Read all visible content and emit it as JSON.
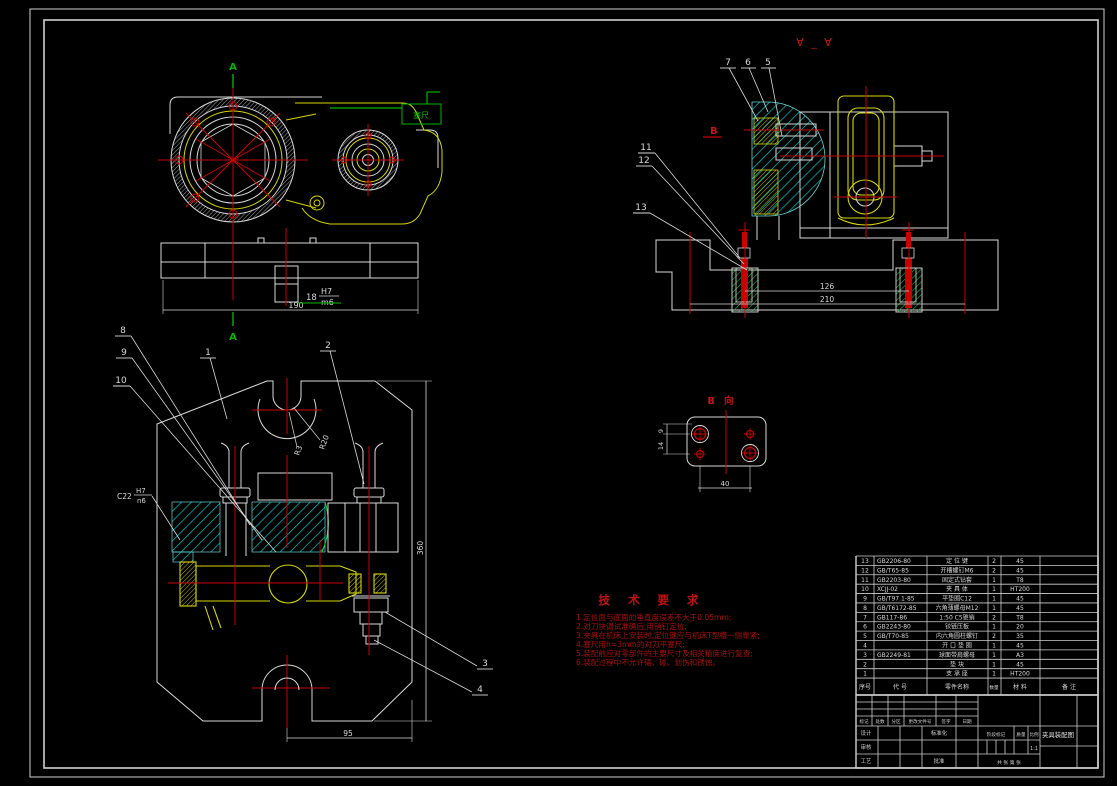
{
  "colors": {
    "background": "#000000",
    "white_line": "#d9d9d9",
    "red_line": "#c80000",
    "green_line": "#00b400",
    "yellow_line": "#d6d600",
    "cyan_hatch": "#00c8c8"
  },
  "labels": {
    "section_a_top": "A",
    "section_a_bottom": "A",
    "section_vv_title": "∀ _ ∀",
    "view_b_title": "B 向",
    "b_ref": "B",
    "feeler": "塞尺"
  },
  "balloons": {
    "1": "1",
    "2": "2",
    "3": "3",
    "4": "4",
    "5": "5",
    "6": "6",
    "7": "7",
    "8": "8",
    "9": "9",
    "10": "10",
    "11": "11",
    "12": "12",
    "13": "13"
  },
  "dims": {
    "d18": "18",
    "fit_u": "H7",
    "fit_l": "m6",
    "d190": "190",
    "d126": "126",
    "d210": "210",
    "d95": "95",
    "d360": "360",
    "d40": "40",
    "d9": "9",
    "d14": "14",
    "r3": "R3",
    "r20": "R20",
    "c22": "C22",
    "c22_u": "H7",
    "c22_l": "n6"
  },
  "tech_req": {
    "title": "技 术 要 求",
    "items": [
      "1.定位面与底面的垂直度误差不大于0.05mm;",
      "2.对刀块调试准确后,用销钉定位;",
      "3.夹具在机床上安装时,定位键应与机床T型槽一侧靠紧;",
      "4.塞尺用h=3mm的对刀平塞尺;",
      "5.装配前应对零部件的主要尺寸及相关精度进行复查;",
      "6.装配过程中不允许磕、碰、划伤和锈蚀。"
    ]
  },
  "bom": {
    "headers": [
      "序号",
      "代  号",
      "零件名称",
      "数量",
      "材 料",
      "备  注"
    ],
    "rows": [
      [
        "13",
        "GB2206-80",
        "定 位 键",
        "2",
        "45",
        ""
      ],
      [
        "12",
        "GB/T65-85",
        "开槽螺钉M6",
        "2",
        "45",
        ""
      ],
      [
        "11",
        "GB2203-80",
        "固定式钻套",
        "1",
        "T8",
        ""
      ],
      [
        "10",
        "XCJJ-02",
        "夹 具 体",
        "1",
        "HT200",
        ""
      ],
      [
        "9",
        "GB/T97.1-85",
        "平垫圈C12",
        "1",
        "45",
        ""
      ],
      [
        "8",
        "GB/T6172-85",
        "六角薄螺母M12",
        "1",
        "45",
        ""
      ],
      [
        "7",
        "GB117-86",
        "1:50 C5锥销",
        "2",
        "T8",
        ""
      ],
      [
        "6",
        "GB2243-80",
        "铰链压板",
        "1",
        "20",
        ""
      ],
      [
        "5",
        "GB/T70-85",
        "内六角圆柱螺钉",
        "2",
        "35",
        ""
      ],
      [
        "4",
        "",
        "开 口 垫 圈",
        "1",
        "45",
        ""
      ],
      [
        "3",
        "GB2249-81",
        "球面带肩螺母",
        "1",
        "A3",
        ""
      ],
      [
        "2",
        "",
        "垫  块",
        "1",
        "45",
        ""
      ],
      [
        "1",
        "",
        "支 承 座",
        "1",
        "HT200",
        ""
      ]
    ]
  },
  "title_block": {
    "revision_headers": [
      "标记",
      "处数",
      "分区",
      "更改文件号",
      "签字",
      "日期"
    ],
    "roles": [
      "设计",
      "审核",
      "工艺"
    ],
    "role_extra_top": "标准化",
    "role_extra_bottom": "批准",
    "stage_headers": [
      "阶段标记",
      "质量",
      "比例"
    ],
    "scale_value": "1:1",
    "sheet_note": "共  张  第  张",
    "drawing_title": "夹具装配图"
  }
}
